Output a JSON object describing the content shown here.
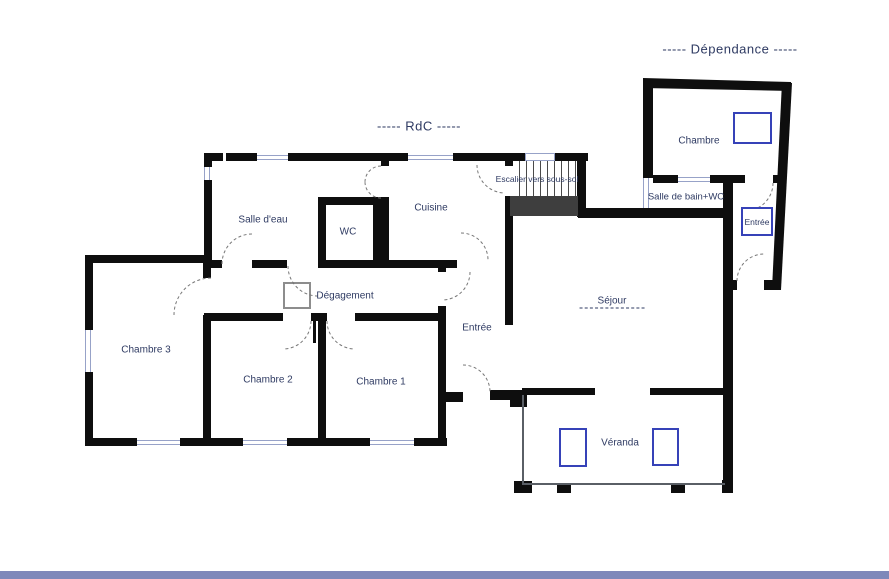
{
  "titles": {
    "rdc": "-----  RdC  -----",
    "dependance": "-----  Dépendance  -----"
  },
  "rooms": {
    "salle_deau": "Salle d'eau",
    "wc": "WC",
    "cuisine": "Cuisine",
    "escalier": "Escalier vers sous-sol",
    "degagement": "Dégagement",
    "chambre3": "Chambre 3",
    "chambre2": "Chambre 2",
    "chambre1": "Chambre 1",
    "entree": "Entrée",
    "sejour": "Séjour",
    "veranda": "Véranda"
  },
  "dependance": {
    "chambre": "Chambre",
    "salle_de_bain_wc": "Salle de bain+WC",
    "entree": "Entrée"
  },
  "colors": {
    "wall": "#0e0e0e",
    "window": "#97a2c8",
    "label": "#2e3a62",
    "velux": "#3642b8",
    "closet": "#8d8d8d",
    "landing": "#3e3e3e",
    "arc": "#777777",
    "thin": "#5a5f66",
    "footer": "#7e88ba"
  }
}
